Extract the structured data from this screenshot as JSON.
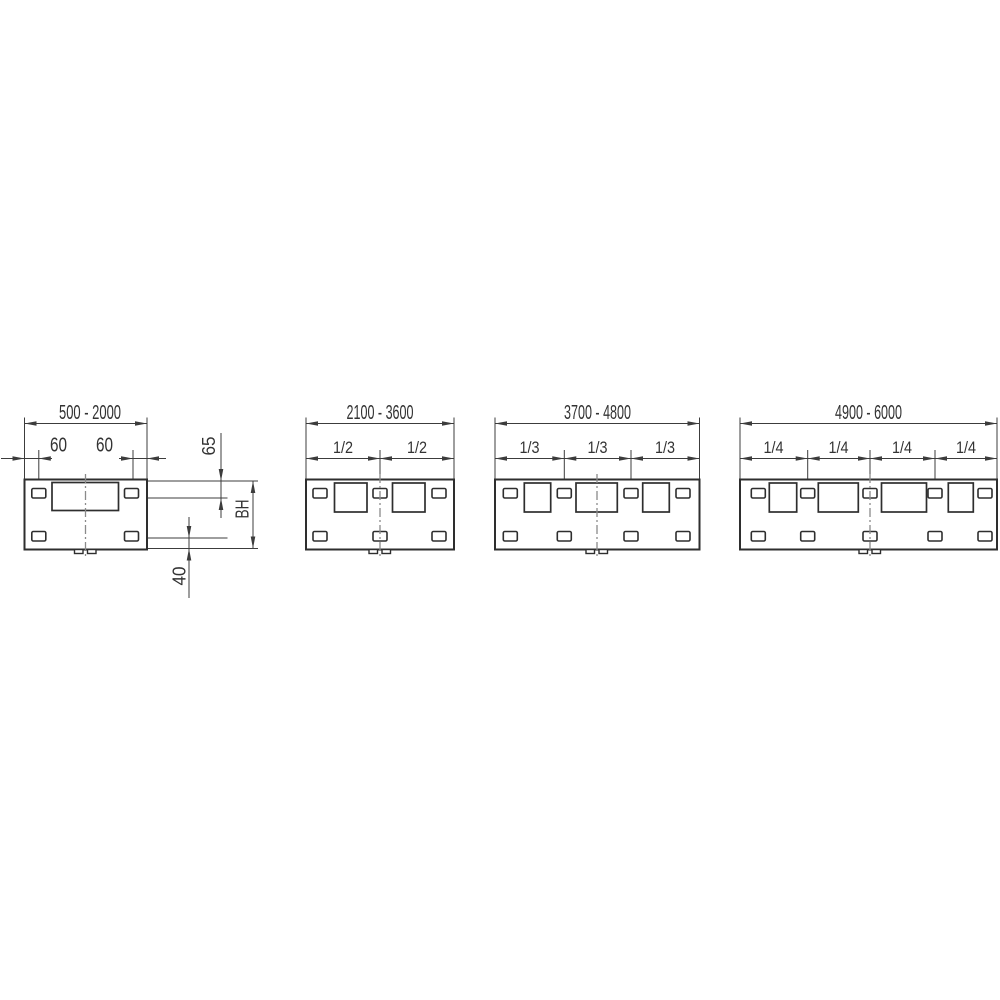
{
  "drawing": {
    "type": "technical-dimension-diagram",
    "background": "#ffffff",
    "colors": {
      "outline": "#2e2e2e",
      "dimension": "#3c3c3c",
      "centerline": "#8a8a8a",
      "text": "#333333"
    },
    "panels": [
      {
        "id": "panel-1",
        "width_range": "500 - 2000",
        "dims": {
          "left_offset": "60",
          "right_offset": "60",
          "top_slot_offset": "65",
          "height_label": "BH",
          "bottom_slot_offset": "40"
        },
        "cutout_count": 1,
        "mounting_slot_count": 4
      },
      {
        "id": "panel-2",
        "width_range": "2100 - 3600",
        "fractions": [
          "1/2",
          "1/2"
        ],
        "cutout_count": 2,
        "mounting_slot_count": 6
      },
      {
        "id": "panel-3",
        "width_range": "3700 - 4800",
        "fractions": [
          "1/3",
          "1/3",
          "1/3"
        ],
        "cutout_count": 3,
        "mounting_slot_count": 8
      },
      {
        "id": "panel-4",
        "width_range": "4900 - 6000",
        "fractions": [
          "1/4",
          "1/4",
          "1/4",
          "1/4"
        ],
        "cutout_count": 4,
        "mounting_slot_count": 10
      }
    ]
  }
}
